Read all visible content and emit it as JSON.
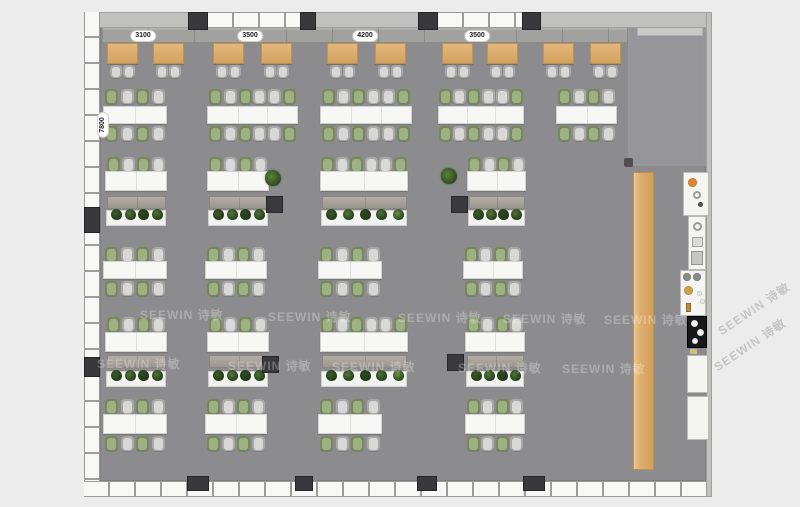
{
  "meta": {
    "title": "Office canteen floor plan",
    "watermark_text": "SEEWIN 诗敏"
  },
  "colors": {
    "background": "#ececec",
    "floor": "#8c8c8e",
    "room_floor": "#95959a",
    "wall_grey": "#c0c0be",
    "window_white": "#f8f8f6",
    "mullion": "#9c9c9a",
    "column_dark": "#39393b",
    "wood_table": "#dcab6c",
    "white_table": "#f7f7f5",
    "bench_grey": "#a8a49d",
    "chair_grey": "#a9a9a7",
    "chair_green": "#76885c",
    "bar_wood": "#e0b377",
    "accent_orange": "#e0862a",
    "brass": "#c9a24a",
    "cooktop_black": "#18181a",
    "planter_white": "#f2f2f0"
  },
  "labels": {
    "top_dims": [
      {
        "text": "3100",
        "cx": 143
      },
      {
        "text": "3500",
        "cx": 250
      },
      {
        "text": "4200",
        "cx": 365
      },
      {
        "text": "3500",
        "cx": 477
      }
    ],
    "top_dims_cy": 36,
    "left_dim": {
      "text": "7800",
      "cx": 103,
      "cy": 125
    }
  },
  "floor_rect": [
    100,
    28,
    606,
    453
  ],
  "walls": {
    "top": {
      "y": 12,
      "h": 16,
      "x": 84,
      "w": 628,
      "windows": [
        [
          208,
          92
        ],
        [
          438,
          84
        ]
      ],
      "columns": [
        [
          188,
          20
        ],
        [
          300,
          16
        ],
        [
          418,
          20
        ],
        [
          522,
          19
        ]
      ]
    },
    "bottom": {
      "y": 481,
      "h": 16,
      "x": 84,
      "w": 628,
      "columns": [
        [
          187,
          22
        ],
        [
          295,
          18
        ],
        [
          417,
          20
        ],
        [
          523,
          22
        ]
      ],
      "col_y": 476,
      "col_h": 15
    },
    "left": {
      "x": 84,
      "w": 16,
      "y": 12,
      "h": 485,
      "columns": [
        [
          207,
          26
        ],
        [
          357,
          20
        ]
      ]
    },
    "right": {
      "x": 706,
      "w": 6,
      "y": 12,
      "h": 485
    }
  },
  "room": {
    "x": 628,
    "y": 12,
    "w": 78,
    "h": 154,
    "shelf": [
      637,
      23,
      66,
      13
    ],
    "dots": [
      [
        624,
        158
      ],
      [
        699,
        12
      ]
    ]
  },
  "banquette": [
    102,
    27,
    526,
    16
  ],
  "cafe": {
    "table_y": 43,
    "table_w": 31,
    "table_h": 21,
    "chair_y": 65,
    "xs": [
      107,
      153,
      213,
      261,
      327,
      375,
      442,
      487,
      543,
      590
    ]
  },
  "chair_patterns": {
    "4": [
      "g",
      "w",
      "g",
      "w"
    ],
    "6": [
      "g",
      "w",
      "g",
      "w",
      "w",
      "g"
    ]
  },
  "dining_rows": [
    {
      "chairs_top": 89,
      "table_y": 106,
      "table_h": 18,
      "chairs_bottom": 126,
      "tables": [
        [
          103,
          64,
          4
        ],
        [
          207,
          91,
          6
        ],
        [
          320,
          92,
          6
        ],
        [
          438,
          86,
          6
        ],
        [
          556,
          61,
          4
        ]
      ]
    },
    {
      "chairs_top": 247,
      "table_y": 261,
      "table_h": 18,
      "chairs_bottom": 281,
      "tables": [
        [
          103,
          64,
          4
        ],
        [
          205,
          62,
          4
        ],
        [
          318,
          64,
          4
        ],
        [
          463,
          60,
          4
        ]
      ]
    },
    {
      "chairs_top": 399,
      "table_y": 414,
      "table_h": 20,
      "chairs_bottom": 436,
      "tables": [
        [
          103,
          64,
          4
        ],
        [
          205,
          62,
          4
        ],
        [
          318,
          64,
          4
        ],
        [
          465,
          60,
          4
        ]
      ]
    }
  ],
  "lounge_rows": [
    {
      "chairs_y": 157,
      "table_y": 171,
      "table_h": 20,
      "bench_y": 196,
      "planter_y": 210,
      "groups": [
        [
          105,
          62,
          4
        ],
        [
          207,
          62,
          4
        ],
        [
          320,
          88,
          6
        ],
        [
          467,
          59,
          4
        ]
      ]
    },
    {
      "chairs_y": 317,
      "table_y": 332,
      "table_h": 20,
      "bench_y": 355,
      "planter_y": 371,
      "groups": [
        [
          105,
          62,
          4
        ],
        [
          207,
          62,
          4
        ],
        [
          320,
          88,
          6
        ],
        [
          465,
          60,
          4
        ]
      ]
    }
  ],
  "pillars": [
    [
      266,
      196
    ],
    [
      451,
      196
    ],
    [
      262,
      356
    ],
    [
      447,
      354
    ]
  ],
  "floor_plants": [
    [
      265,
      170
    ],
    [
      441,
      168
    ]
  ],
  "plant_colors": [
    "#3d5a2c",
    "#55793a",
    "#2e4a23",
    "#4e7338",
    "#6b9448"
  ],
  "bar_counter": [
    633,
    172,
    21,
    298
  ],
  "kitchen_units": [
    {
      "x": 683,
      "y": 172,
      "w": 26,
      "h": 44,
      "black": false,
      "items": [
        [
          "dot",
          4,
          5,
          9,
          "#e0862a"
        ],
        [
          "ring",
          9,
          18,
          8,
          "#9a9a98"
        ],
        [
          "dot",
          14,
          29,
          5,
          "#555557"
        ]
      ]
    },
    {
      "x": 688,
      "y": 216,
      "w": 18,
      "h": 54,
      "black": false,
      "items": [
        [
          "ring",
          4,
          5,
          9,
          "#9a9a98"
        ],
        [
          "rect",
          3,
          20,
          11,
          10,
          "#dadad8"
        ],
        [
          "rect",
          2,
          34,
          12,
          14,
          "#c6c6c4"
        ]
      ]
    },
    {
      "x": 680,
      "y": 270,
      "w": 26,
      "h": 46,
      "black": false,
      "items": [
        [
          "dot",
          2,
          2,
          8,
          "#8a8a88"
        ],
        [
          "dot",
          12,
          2,
          8,
          "#8a8a88"
        ],
        [
          "dot",
          3,
          15,
          9,
          "#c9a24a"
        ],
        [
          "dot",
          16,
          20,
          5,
          "#e8e8e6"
        ],
        [
          "dot",
          19,
          28,
          5,
          "#e8e8e6"
        ],
        [
          "rect",
          5,
          32,
          5,
          9,
          "#b98c3c"
        ]
      ]
    },
    {
      "x": 687,
      "y": 316,
      "w": 20,
      "h": 32,
      "black": true,
      "items": [
        [
          "dot",
          3,
          3,
          7,
          "#f2f2f0"
        ],
        [
          "dot",
          9,
          12,
          7,
          "#f2f2f0"
        ],
        [
          "dot",
          4,
          21,
          6,
          "#f2f2f0"
        ]
      ]
    },
    {
      "x": 690,
      "y": 349,
      "w": 7,
      "h": 5,
      "black": false,
      "bg": "#e2c23c",
      "items": []
    },
    {
      "x": 687,
      "y": 355,
      "w": 21,
      "h": 38,
      "black": false,
      "items": []
    },
    {
      "x": 687,
      "y": 396,
      "w": 22,
      "h": 44,
      "black": false,
      "items": []
    }
  ],
  "watermarks": {
    "floor": [
      [
        140,
        306
      ],
      [
        268,
        308
      ],
      [
        398,
        309
      ],
      [
        503,
        310
      ],
      [
        604,
        311
      ],
      [
        97,
        355
      ],
      [
        228,
        357
      ],
      [
        332,
        358
      ],
      [
        458,
        359
      ],
      [
        562,
        360
      ]
    ],
    "side": [
      [
        712,
        300
      ],
      [
        708,
        336
      ]
    ]
  }
}
